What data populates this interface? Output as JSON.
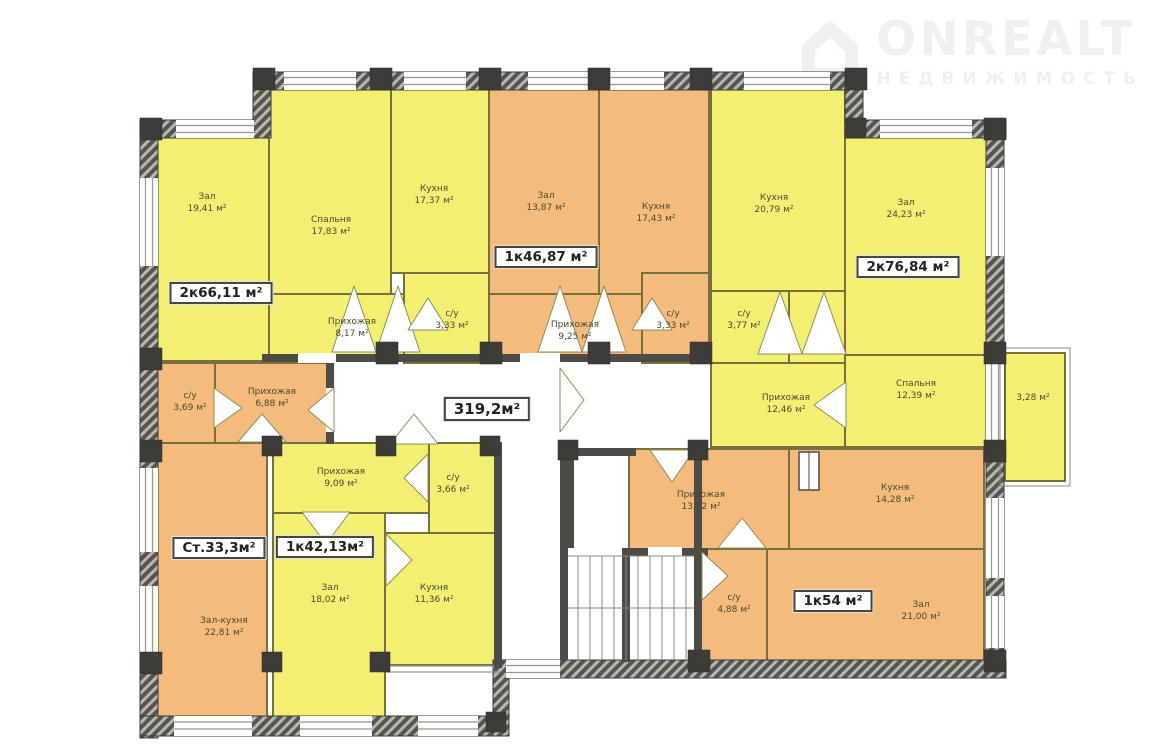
{
  "watermark": {
    "brand": "ONREALT",
    "subtitle": "НЕДВИЖИМОСТЬ"
  },
  "corridor": {
    "area_badge": "319,2м²"
  },
  "palette": {
    "room_yellow": "#f3ef72",
    "room_orange": "#f5bb7d",
    "wall_dark": "#57554f",
    "partition_olive": "#76713c",
    "watermark_gray": "#eef1f1"
  },
  "apartments": [
    {
      "badge": "2к66,11 м²",
      "rooms": [
        {
          "name": "Зал",
          "area": "19,41 м²"
        },
        {
          "name": "Спальня",
          "area": "17,83 м²"
        },
        {
          "name": "Кухня",
          "area": "17,37 м²"
        },
        {
          "name": "Прихожая",
          "area": "8,17 м²"
        },
        {
          "name": "с/у",
          "area": "3,33 м²"
        }
      ]
    },
    {
      "badge": "1к46,87 м²",
      "rooms": [
        {
          "name": "Зал",
          "area": "13,87 м²"
        },
        {
          "name": "Кухня",
          "area": "17,43 м²"
        },
        {
          "name": "Прихожая",
          "area": "9,25 м²"
        },
        {
          "name": "с/у",
          "area": "3,33 м²"
        }
      ]
    },
    {
      "badge": "2к76,84 м²",
      "rooms": [
        {
          "name": "Кухня",
          "area": "20,79 м²"
        },
        {
          "name": "Зал",
          "area": "24,23 м²"
        },
        {
          "name": "с/у",
          "area": "3,77 м²"
        },
        {
          "name": "Прихожая",
          "area": "12,46 м²"
        },
        {
          "name": "Спальня",
          "area": "12,39 м²"
        },
        {
          "name": "",
          "area": "3,28 м²"
        }
      ]
    },
    {
      "badge": "Ст.33,3м²",
      "rooms": [
        {
          "name": "с/у",
          "area": "3,69 м²"
        },
        {
          "name": "Прихожая",
          "area": "6,88 м²"
        },
        {
          "name": "Зал-кухня",
          "area": "22,81 м²"
        }
      ]
    },
    {
      "badge": "1к42,13м²",
      "rooms": [
        {
          "name": "Прихожая",
          "area": "9,09 м²"
        },
        {
          "name": "с/у",
          "area": "3,66 м²"
        },
        {
          "name": "Зал",
          "area": "18,02 м²"
        },
        {
          "name": "Кухня",
          "area": "11,36 м²"
        }
      ]
    },
    {
      "badge": "1к54 м²",
      "rooms": [
        {
          "name": "Прихожая",
          "area": "13,92 м²"
        },
        {
          "name": "Кухня",
          "area": "14,28 м²"
        },
        {
          "name": "с/у",
          "area": "4,88 м²"
        },
        {
          "name": "Зал",
          "area": "21,00 м²"
        }
      ]
    }
  ]
}
